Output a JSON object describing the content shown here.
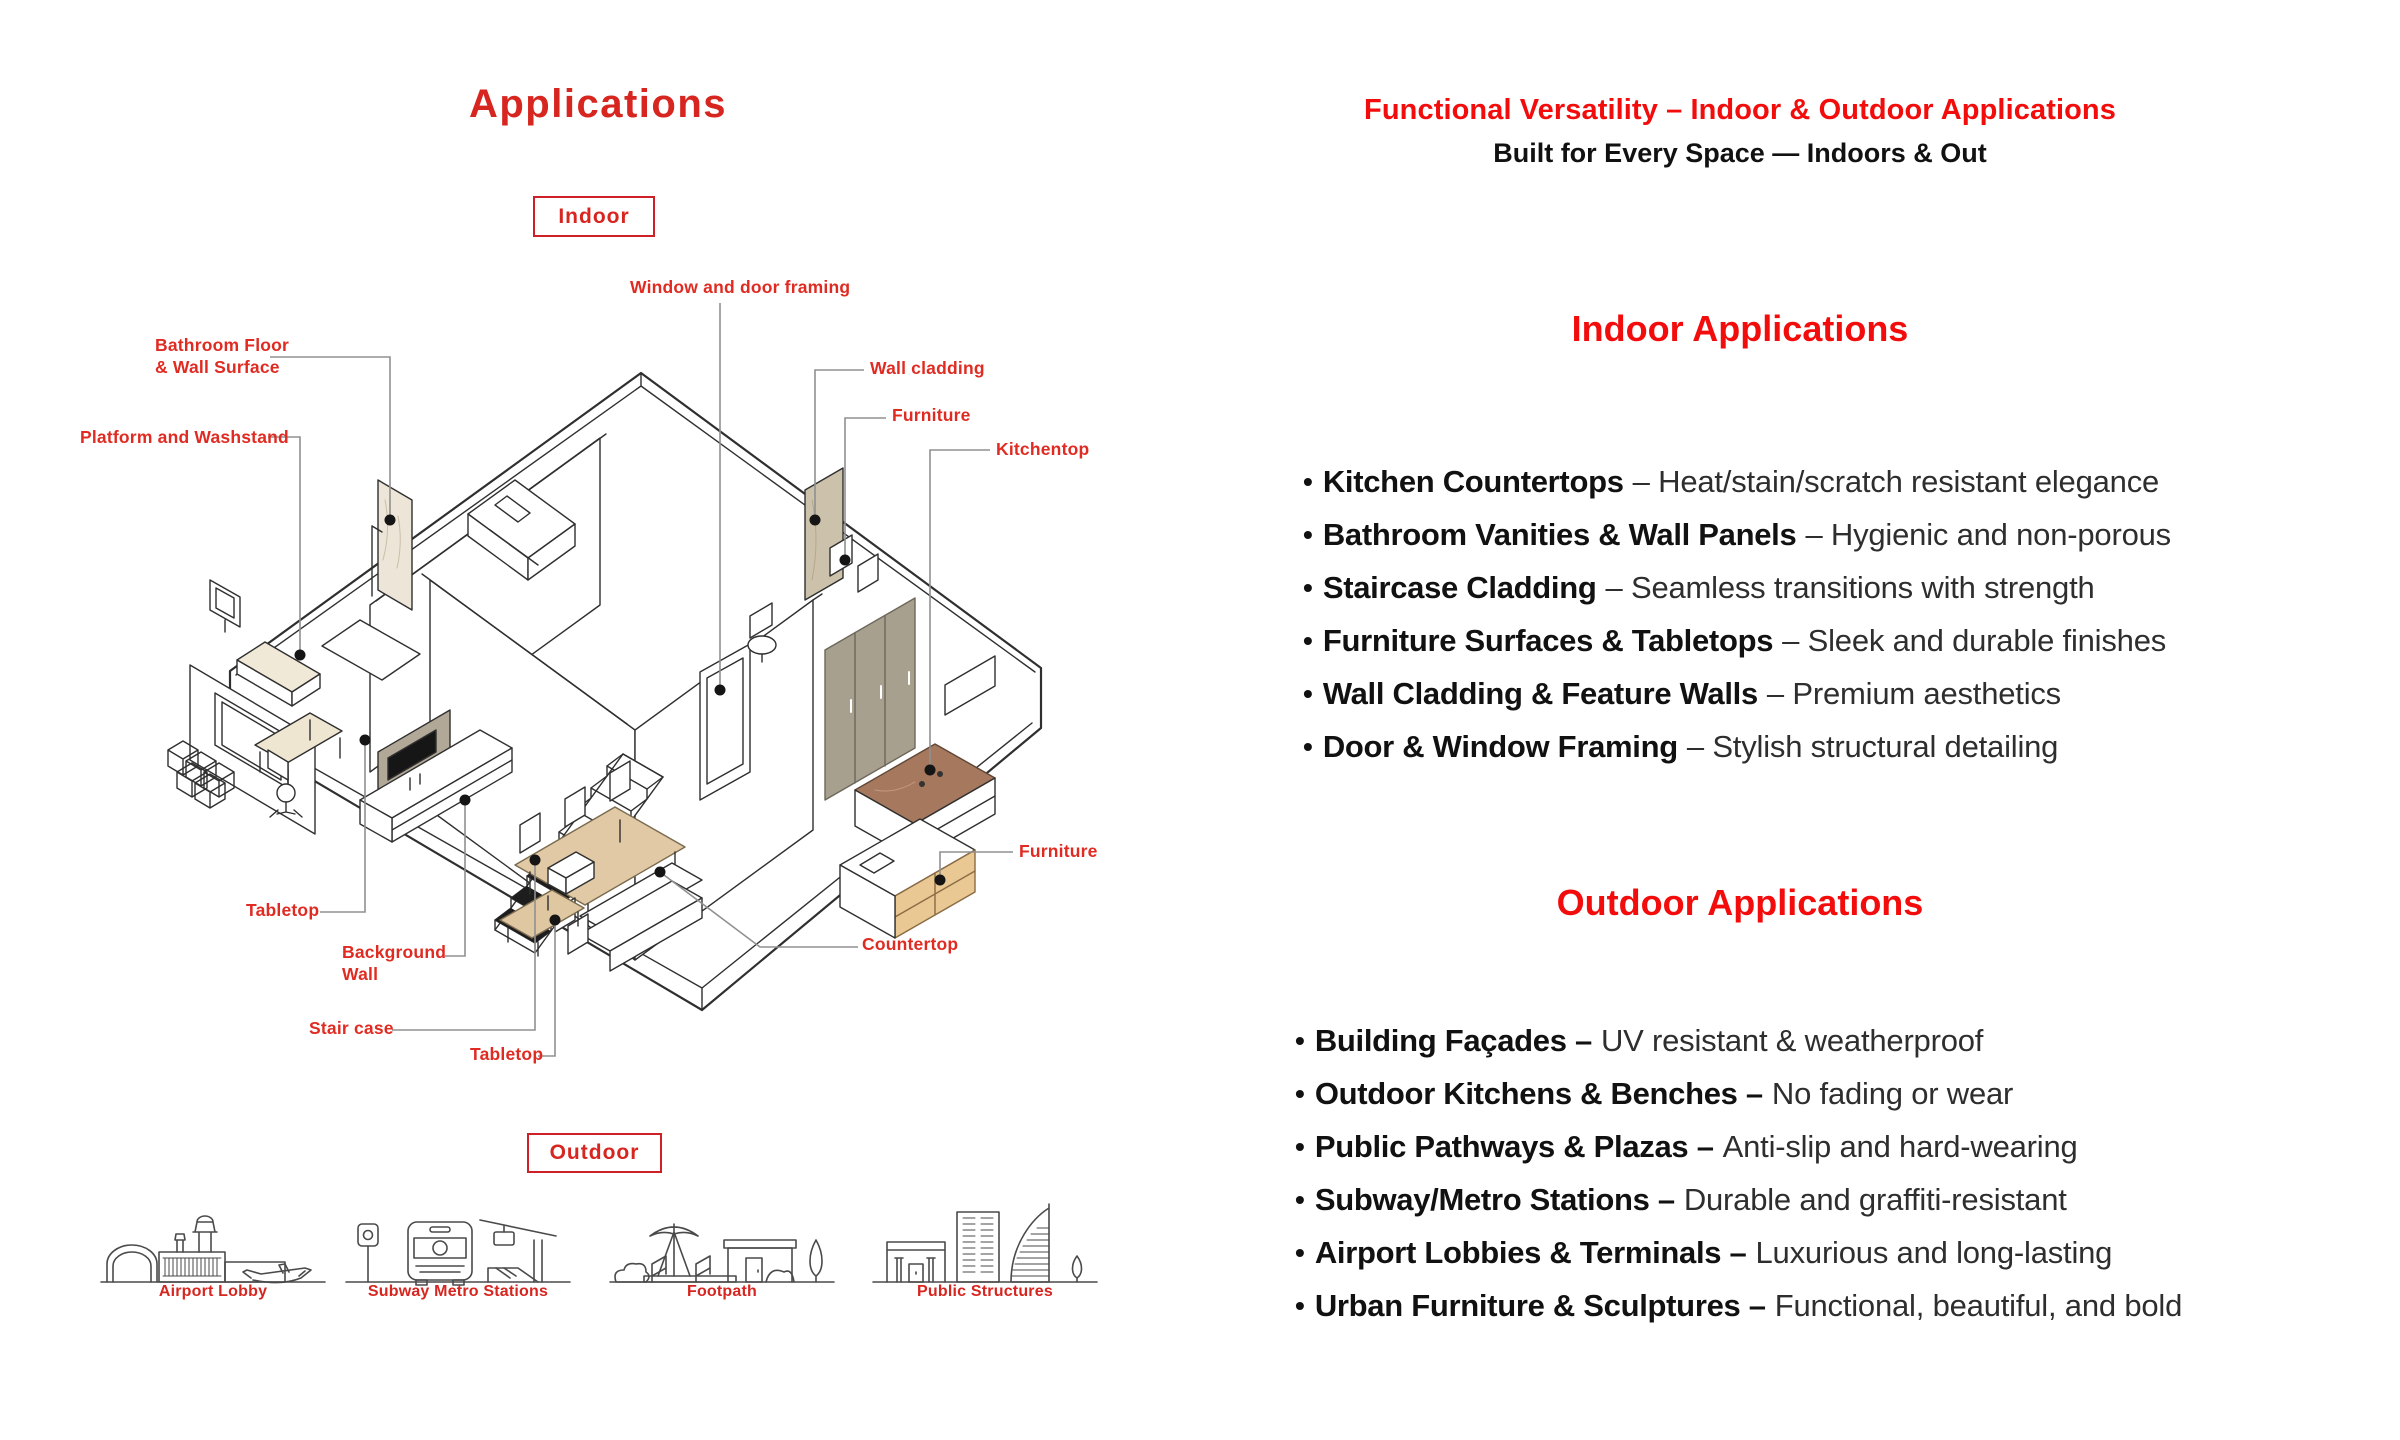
{
  "left": {
    "title": "Applications",
    "indoor_tag": "Indoor",
    "outdoor_tag": "Outdoor",
    "diagram_labels": {
      "bathroom_line1": "Bathroom Floor",
      "bathroom_line2": "& Wall Surface",
      "platform": "Platform and Washstand",
      "window": "Window and door framing",
      "wall_cladding": "Wall cladding",
      "furniture_top": "Furniture",
      "kitchentop": "Kitchentop",
      "furniture_right": "Furniture",
      "countertop": "Countertop",
      "tabletop_left": "Tabletop",
      "background_line1": "Background",
      "background_line2": "Wall",
      "staircase": "Stair case",
      "tabletop_bottom": "Tabletop"
    },
    "outdoor_icons": [
      {
        "label": "Airport Lobby"
      },
      {
        "label": "Subway Metro Stations"
      },
      {
        "label": "Footpath"
      },
      {
        "label": "Public Structures"
      }
    ]
  },
  "right": {
    "header_red": "Functional Versatility – Indoor & Outdoor Applications",
    "header_black": "Built for Every Space — Indoors & Out",
    "indoor_heading": "Indoor Applications",
    "outdoor_heading": "Outdoor Applications",
    "bullet": "•",
    "indoor_items": [
      {
        "term": "Kitchen Countertops",
        "desc": "– Heat/stain/scratch resistant elegance"
      },
      {
        "term": "Bathroom Vanities & Wall Panels",
        "desc": "– Hygienic and non-porous"
      },
      {
        "term": "Staircase Cladding",
        "desc": "– Seamless transitions with strength"
      },
      {
        "term": "Furniture Surfaces & Tabletops",
        "desc": "– Sleek and durable finishes"
      },
      {
        "term": "Wall Cladding & Feature Walls",
        "desc": "– Premium aesthetics"
      },
      {
        "term": "Door & Window Framing",
        "desc": "– Stylish structural detailing"
      }
    ],
    "outdoor_items": [
      {
        "term": "Building Façades –",
        "desc": "UV resistant & weatherproof"
      },
      {
        "term": "Outdoor Kitchens & Benches –",
        "desc": "No fading or wear"
      },
      {
        "term": "Public Pathways & Plazas –",
        "desc": "Anti-slip and hard-wearing"
      },
      {
        "term": "Subway/Metro Stations –",
        "desc": "Durable and graffiti-resistant"
      },
      {
        "term": "Airport Lobbies & Terminals –",
        "desc": "Luxurious and long-lasting"
      },
      {
        "term": "Urban Furniture & Sculptures –",
        "desc": "Functional, beautiful, and bold"
      }
    ]
  },
  "colors": {
    "accent_red": "#e02b22",
    "heading_red": "#f30c0c",
    "title_red": "#d7251f",
    "box_red": "#cf2027",
    "beige": "#e0c9a4",
    "wood": "#eac893",
    "taupe": "#a8a08f",
    "brown_marble": "#a6795e",
    "gray_marble": "#b2a898",
    "light_marble": "#ece5d8"
  }
}
